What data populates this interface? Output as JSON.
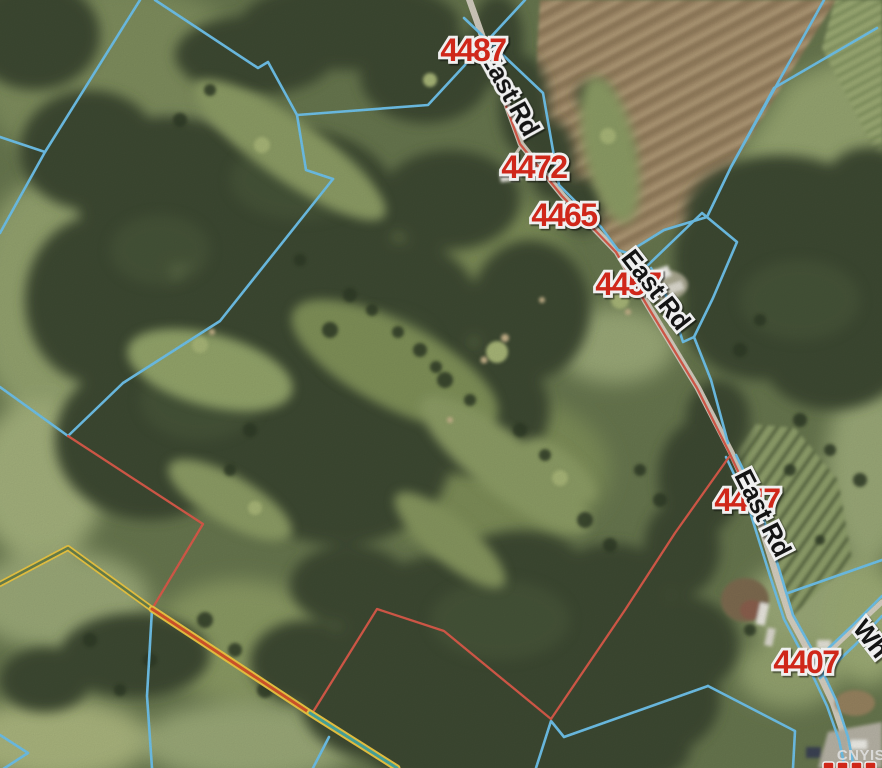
{
  "map": {
    "view": "aerial-parcel-map",
    "address_labels": [
      "4487",
      "4472",
      "4465",
      "4457",
      "4447",
      "4407"
    ],
    "road_labels": [
      "East Rd",
      "East Rd",
      "East Rd"
    ],
    "partial_road_label": "Wh",
    "watermark": "CNYIS",
    "colors": {
      "parcel_line_blue": "#6fc2ea",
      "parcel_line_red": "#d95b4a",
      "boundary_yellow": "#eec843",
      "boundary_orange_core": "#d6552b",
      "boundary_teal_core": "#49a8a0",
      "address_label_red": "#dd2a1b",
      "road_label_black": "#141414",
      "label_halo_white": "#ffffff",
      "road_pale": "#d9d2c5"
    }
  }
}
